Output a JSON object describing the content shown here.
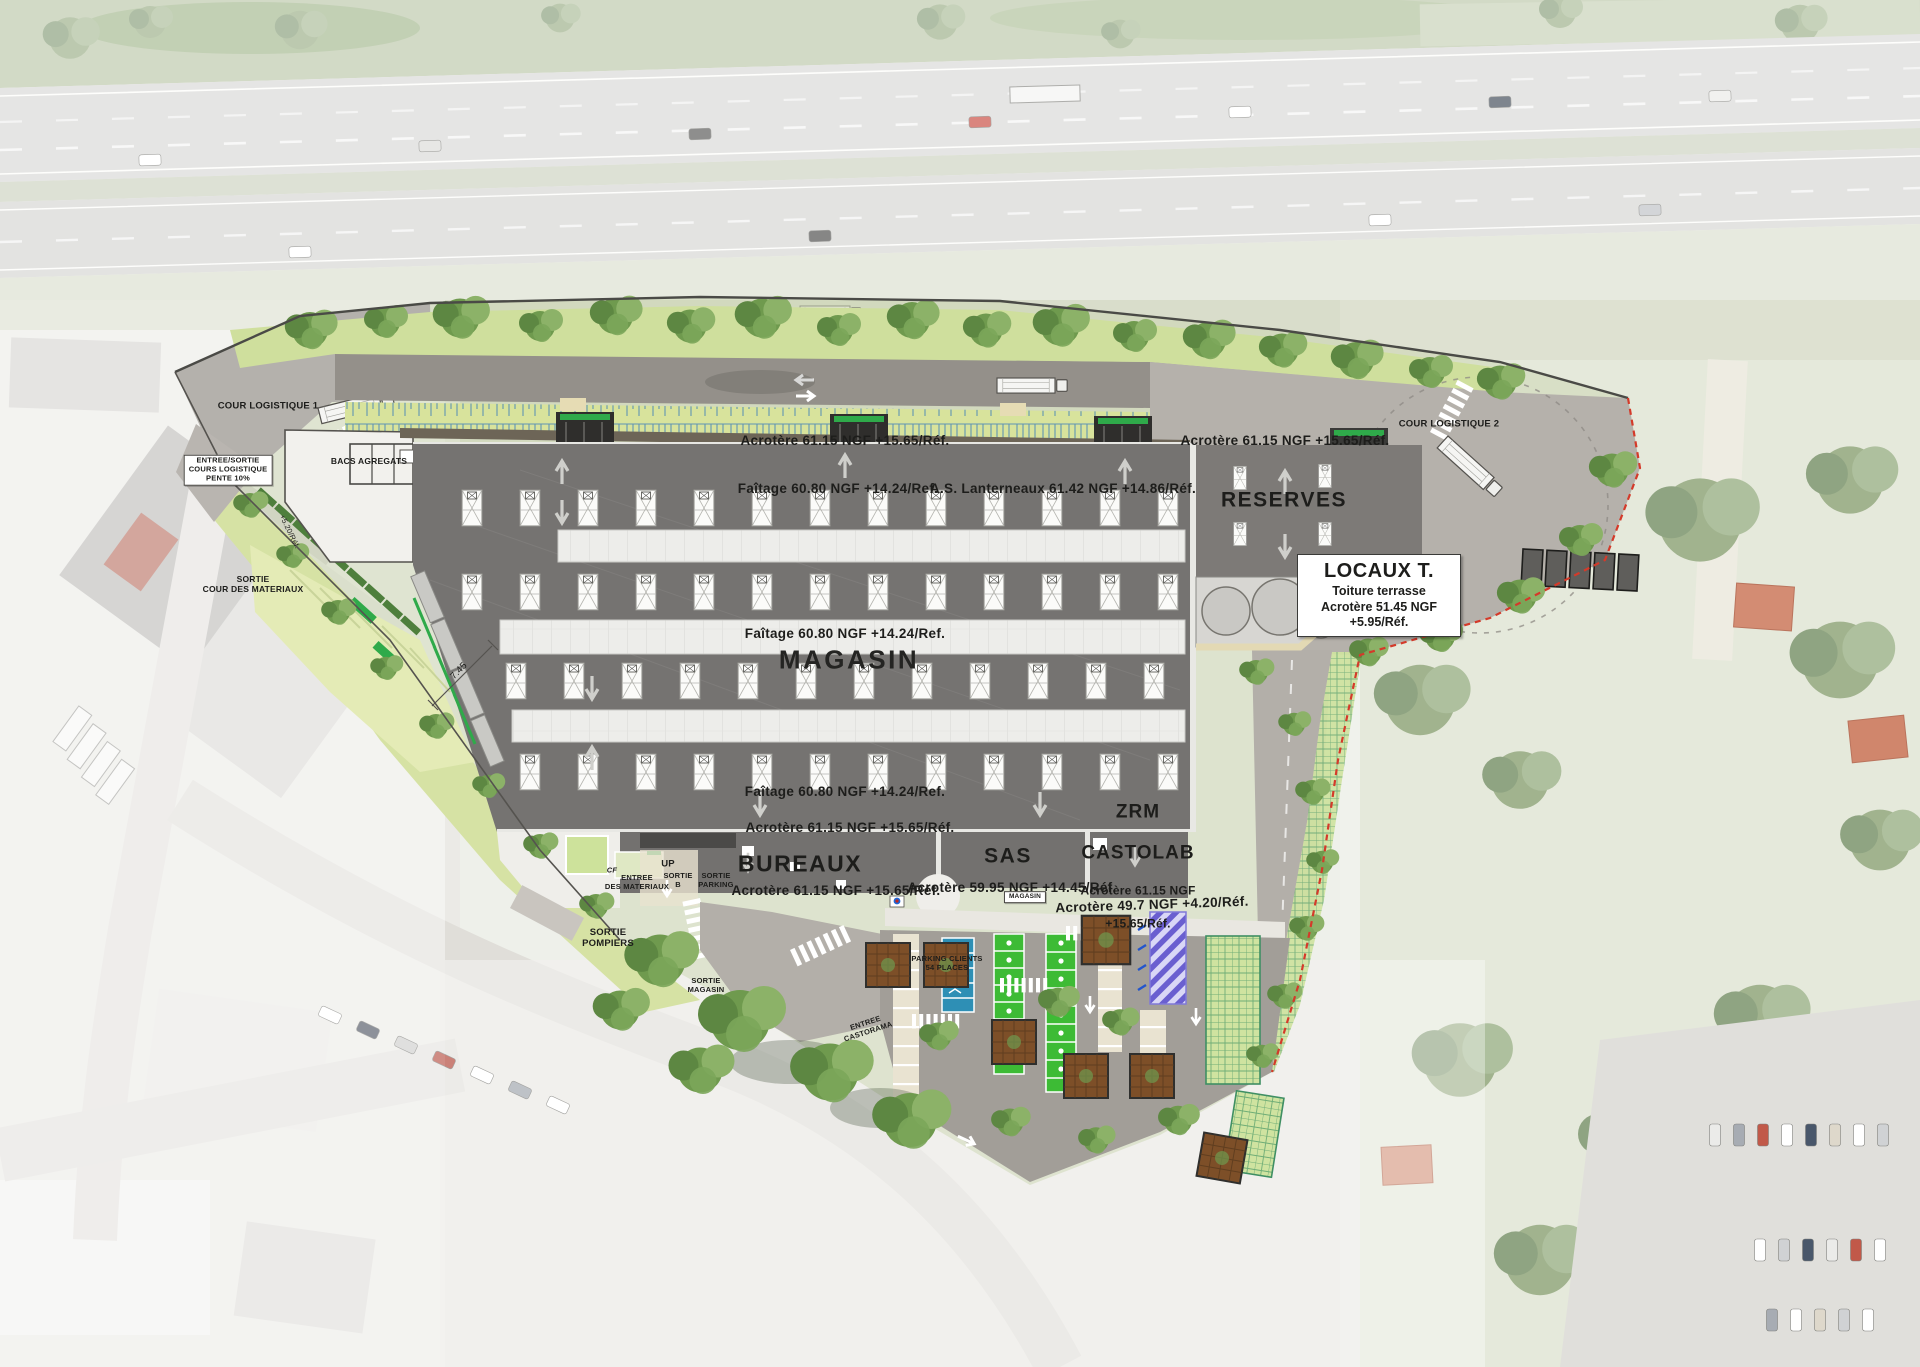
{
  "labels": {
    "acrotere_top": "Acrotère 61.15 NGF +15.65/Réf.",
    "faitage_top": "Faîtage 60.80 NGF  +14.24/Ref.",
    "lanterneaux": "A.S. Lanterneaux 61.42 NGF  +14.86/Réf.",
    "acrotere_reserves": "Acrotère 61.15 NGF +15.65/Réf.",
    "reserves": "RESERVES",
    "locaux_title": "LOCAUX T.",
    "locaux_l1": "Toiture terrasse",
    "locaux_l2": "Acrotère 51.45 NGF",
    "locaux_l3": "+5.95/Réf.",
    "faitage_mid": "Faîtage 60.80 NGF  +14.24/Ref.",
    "magasin": "MAGASIN",
    "faitage_bottom": "Faîtage 60.80 NGF  +14.24/Ref.",
    "acrotere_bureaux_top": "Acrotère 61.15 NGF +15.65/Réf.",
    "bureaux": "BUREAUX",
    "sas": "SAS",
    "zrm_l1": "ZRM",
    "zrm_l2": "CASTOLAB",
    "zrm_l3": "Acrotère 61.15 NGF",
    "zrm_l4": "+15.65/Réf.",
    "acrotere_bureaux_bottom": "Acrotère 61.15 NGF +15.65/Réf.",
    "acrotere_sas": "Acrotère 59.95 NGF +14.45/Réf.",
    "acrotere_parking": "Acrotère 49.7 NGF +4.20/Réf.",
    "cour1": "COUR LOGISTIQUE 1",
    "cour2": "COUR LOGISTIQUE 2",
    "entree_sortie_cours": "ENTREE/SORTIE\nCOURS LOGISTIQUE\nPENTE 10%",
    "bacs_agregats": "BACS AGREGATS",
    "sortie_materiaux": "SORTIE\nCOUR DES MATERIAUX",
    "dim_745": "7.45",
    "plus_520": "+5.20/Réf.",
    "entree_materiaux": "ENTREE\nDES MATERIAUX",
    "sortie_b": "SORTIE\nB",
    "sortie_parking": "SORTIE\nPARKING",
    "up": "UP",
    "cf": "CF",
    "sortie_pompiers": "SORTIE\nPOMPIERS",
    "sortie_magasin": "SORTIE\nMAGASIN",
    "parking_clients": "PARKING CLIENTS\n54 PLACES",
    "entree_castorama": "ENTREE\nCASTORAMA",
    "magasin_chip": "MAGASIN"
  },
  "colors": {
    "roof": "#757371",
    "roof_reserves": "#7d7a77",
    "stall_green": "#3dbb35",
    "stall_blue": "#2e8fb5",
    "hatch_violet": "#6a5fd0",
    "swale_blue": "#4b86b8",
    "lawn": "#cfdf9d",
    "boundary_red": "#d43a2a",
    "accent_green": "#2faa4a"
  }
}
